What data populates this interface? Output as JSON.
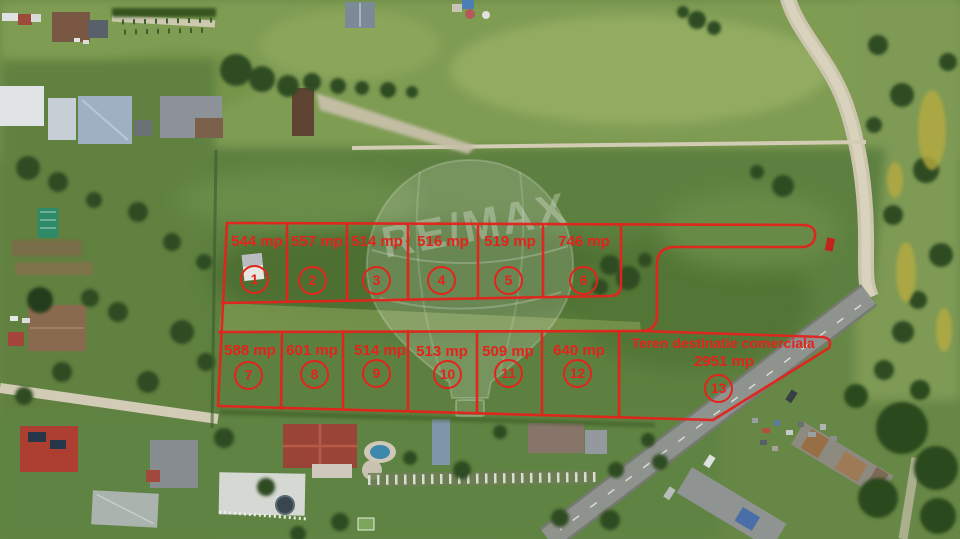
{
  "brand_watermark": "RE/MAX",
  "overlay": {
    "color": "#e3231c",
    "unit": "mp",
    "top_row_plots": [
      {
        "number": "1",
        "area": "544 mp"
      },
      {
        "number": "2",
        "area": "557 mp"
      },
      {
        "number": "3",
        "area": "514 mp"
      },
      {
        "number": "4",
        "area": "516 mp"
      },
      {
        "number": "5",
        "area": "519 mp"
      },
      {
        "number": "6",
        "area": "746 mp"
      }
    ],
    "bottom_row_plots": [
      {
        "number": "7",
        "area": "588 mp"
      },
      {
        "number": "8",
        "area": "601 mp"
      },
      {
        "number": "9",
        "area": "514 mp"
      },
      {
        "number": "10",
        "area": "513 mp"
      },
      {
        "number": "11",
        "area": "509 mp"
      },
      {
        "number": "12",
        "area": "640 mp"
      }
    ],
    "commercial_plot": {
      "number": "13",
      "title": "Teren destinatie comerciala",
      "area": "2951 mp"
    }
  }
}
